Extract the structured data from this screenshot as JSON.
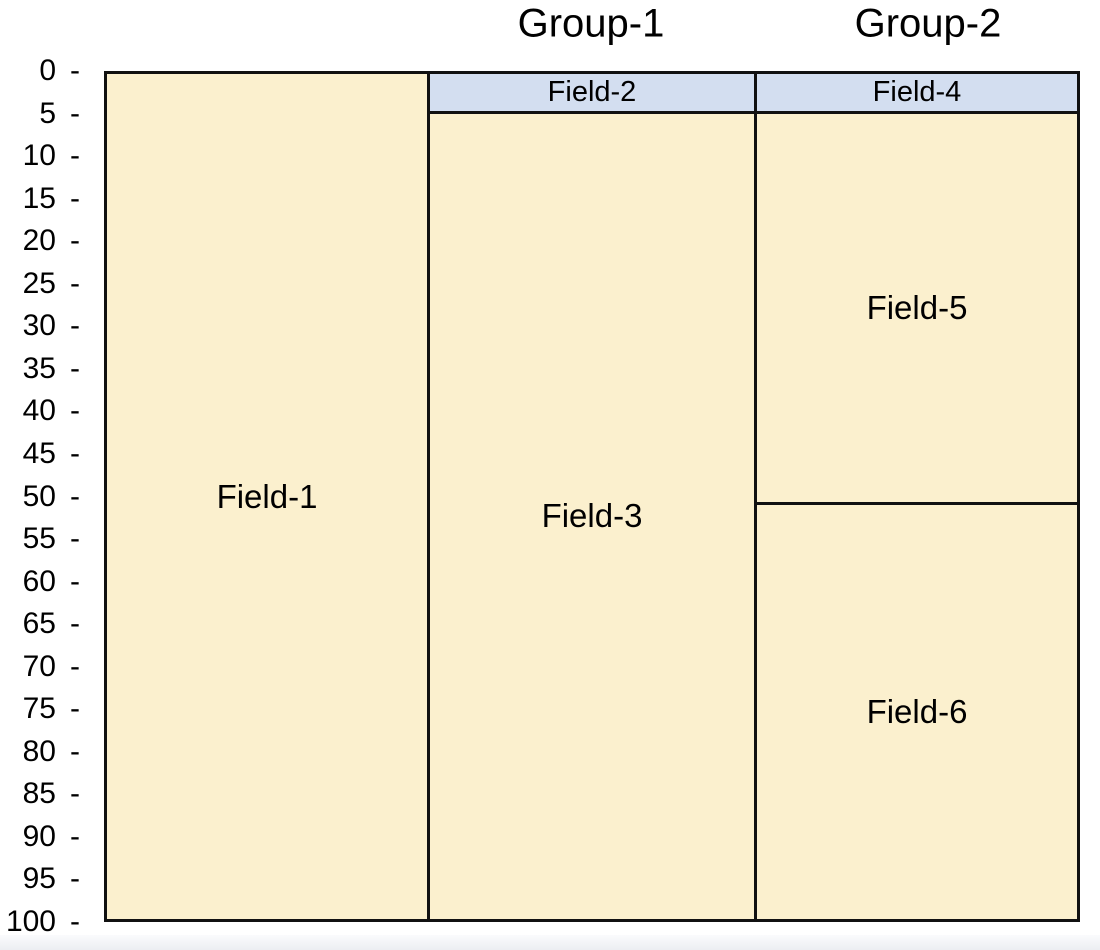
{
  "figure": {
    "background": "#ffffff",
    "bottom_strip_color": "#eceef2"
  },
  "chart_data": {
    "type": "bar",
    "subtype": "mosaic-field-map (stacked columns, inverted y)",
    "title": "",
    "xlabel": "",
    "ylabel": "",
    "group_titles": [
      "Group-1",
      "Group-2"
    ],
    "y_axis": {
      "min": 0,
      "max": 100,
      "tick_step": 5,
      "inverted": true,
      "tick_mark": "-",
      "ticks": [
        "0",
        "5",
        "10",
        "15",
        "20",
        "25",
        "30",
        "35",
        "40",
        "45",
        "50",
        "55",
        "60",
        "65",
        "70",
        "75",
        "80",
        "85",
        "90",
        "95",
        "100"
      ]
    },
    "columns": [
      {
        "id": "field-1-column",
        "group": "",
        "x_px": 0,
        "w_px": 326,
        "segments": [
          {
            "label": "Field-1",
            "start": 0,
            "end": 100,
            "fill": "cream"
          }
        ]
      },
      {
        "id": "group-1-column",
        "group": "Group-1",
        "title_center_x": 591,
        "x_px": 326,
        "w_px": 327,
        "segments": [
          {
            "label": "Field-2",
            "start": 0,
            "end": 5,
            "fill": "blue"
          },
          {
            "label": "Field-3",
            "start": 5,
            "end": 100,
            "fill": "cream"
          }
        ]
      },
      {
        "id": "group-2-column",
        "group": "Group-2",
        "title_center_x": 928,
        "x_px": 653,
        "w_px": 323,
        "segments": [
          {
            "label": "Field-4",
            "start": 0,
            "end": 5,
            "fill": "blue"
          },
          {
            "label": "Field-5",
            "start": 5,
            "end": 51,
            "fill": "cream"
          },
          {
            "label": "Field-6",
            "start": 51,
            "end": 100,
            "fill": "cream"
          }
        ]
      }
    ],
    "colors": {
      "cream": "#FBF0CE",
      "blue": "#D3DEF0",
      "border": "#111111",
      "text": "#000000"
    },
    "layout_px": {
      "left": 104,
      "top": 71,
      "width": 976,
      "height": 851,
      "border": 3,
      "title_center_y": 24,
      "tick_box_right": 82
    }
  }
}
